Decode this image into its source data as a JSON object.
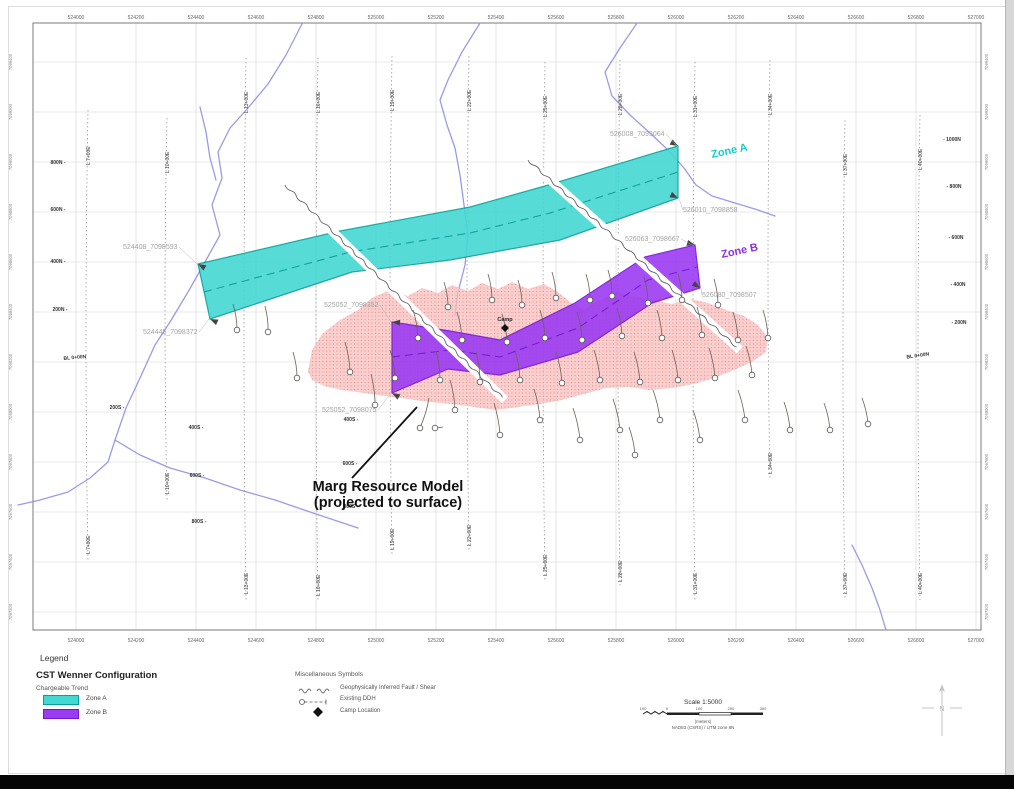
{
  "map": {
    "frame": {
      "left": 33,
      "top": 23,
      "right": 981,
      "bottom": 630
    },
    "grid": {
      "x0": 76,
      "dx": 60,
      "y0": 62,
      "dy": 50
    },
    "easting_labels": [
      "524000",
      "524200",
      "524400",
      "524600",
      "524800",
      "525000",
      "525200",
      "525400",
      "525600",
      "525800",
      "526000",
      "526200",
      "526400",
      "526600",
      "526800",
      "527000"
    ],
    "northing_labels": [
      "7099400",
      "7099200",
      "7099000",
      "7098800",
      "7098600",
      "7098400",
      "7098200",
      "7098000",
      "7097800",
      "7097600",
      "7097400",
      "7097200"
    ],
    "colors": {
      "grid": "#d2d2d2",
      "frame": "#7a7a7a",
      "stream": "#8f8fe8",
      "survey": "#9a9a9a",
      "zone_a_fill": "#44D8D2",
      "zone_a_border": "#0A9E98",
      "zone_a_text": "#17CCC6",
      "zone_b_fill": "#9B3BF2",
      "zone_b_border": "#7716D8",
      "zone_b_text": "#8B2BE8",
      "blob_fill": "#F7C2C0",
      "blob_dots": "#E4908C",
      "fault": "#555555",
      "drill": "#555555",
      "label_gray": "#A3A3A3",
      "axis_text": "#666666"
    },
    "survey_lines": [
      {
        "x": 88,
        "y1": 110,
        "y2": 560,
        "label": "L 7+00E"
      },
      {
        "x": 167,
        "y1": 118,
        "y2": 500,
        "label": "L 10+00E"
      },
      {
        "x": 246,
        "y1": 58,
        "y2": 600,
        "label": "L 13+00E"
      },
      {
        "x": 318,
        "y1": 58,
        "y2": 602,
        "label": "L 16+00E"
      },
      {
        "x": 392,
        "y1": 56,
        "y2": 556,
        "label": "L 19+00E"
      },
      {
        "x": 469,
        "y1": 56,
        "y2": 552,
        "label": "L 22+00E"
      },
      {
        "x": 545,
        "y1": 62,
        "y2": 582,
        "label": "L 25+00E"
      },
      {
        "x": 620,
        "y1": 60,
        "y2": 588,
        "label": "L 28+00E"
      },
      {
        "x": 695,
        "y1": 62,
        "y2": 600,
        "label": "L 31+00E"
      },
      {
        "x": 770,
        "y1": 60,
        "y2": 480,
        "label": "L 34+00E"
      },
      {
        "x": 845,
        "y1": 120,
        "y2": 600,
        "label": "L 37+00E"
      },
      {
        "x": 920,
        "y1": 115,
        "y2": 600,
        "label": "L 40+00E"
      }
    ],
    "local_labels": [
      {
        "t": "800N -",
        "x": 58,
        "y": 164
      },
      {
        "t": "600N -",
        "x": 58,
        "y": 211
      },
      {
        "t": "400N -",
        "x": 58,
        "y": 263
      },
      {
        "t": "200N -",
        "x": 60,
        "y": 311
      },
      {
        "t": "- 1000N",
        "x": 952,
        "y": 141
      },
      {
        "t": "- 800N",
        "x": 954,
        "y": 188
      },
      {
        "t": "- 600N",
        "x": 956,
        "y": 239
      },
      {
        "t": "- 400N",
        "x": 958,
        "y": 286
      },
      {
        "t": "- 200N",
        "x": 959,
        "y": 324
      },
      {
        "t": "200S -",
        "x": 117,
        "y": 409
      },
      {
        "t": "400S -",
        "x": 196,
        "y": 429
      },
      {
        "t": "600S -",
        "x": 197,
        "y": 477
      },
      {
        "t": "800S -",
        "x": 199,
        "y": 523
      },
      {
        "t": "400S -",
        "x": 351,
        "y": 421
      },
      {
        "t": "600S -",
        "x": 350,
        "y": 465
      },
      {
        "t": "800S -",
        "x": 351,
        "y": 508
      }
    ],
    "baseline_labels": [
      {
        "t": "BL 0+00N",
        "x": 75,
        "y": 359,
        "rot": -5
      },
      {
        "t": "BL 0+00N",
        "x": 918,
        "y": 357,
        "rot": -8
      }
    ],
    "collar_labels": [
      {
        "t": "524408_7098593",
        "x": 123,
        "y": 249,
        "tip": [
          197,
          264
        ]
      },
      {
        "t": "524445_7098372",
        "x": 143,
        "y": 334,
        "tip": [
          209,
          319
        ]
      },
      {
        "t": "525052_7098352",
        "x": 324,
        "y": 307,
        "tip": [
          391,
          322
        ]
      },
      {
        "t": "525052_7098075",
        "x": 322,
        "y": 412,
        "tip": [
          391,
          393
        ]
      },
      {
        "t": "526008_7099064",
        "x": 610,
        "y": 136,
        "tip": [
          678,
          147
        ]
      },
      {
        "t": "526010_7098858",
        "x": 683,
        "y": 212,
        "tip": [
          679,
          199
        ]
      },
      {
        "t": "526063_7098667",
        "x": 625,
        "y": 241,
        "tip": [
          694,
          246
        ]
      },
      {
        "t": "526080_7098507",
        "x": 702,
        "y": 297,
        "tip": [
          701,
          289
        ]
      }
    ],
    "zone_a": {
      "label": "Zone A",
      "label_x": 712,
      "label_y": 158,
      "label_rot": -12,
      "polygon": [
        [
          198,
          264
        ],
        [
          340,
          231
        ],
        [
          470,
          207
        ],
        [
          545,
          186
        ],
        [
          678,
          146
        ],
        [
          678,
          198
        ],
        [
          560,
          240
        ],
        [
          450,
          260
        ],
        [
          352,
          272
        ],
        [
          210,
          319
        ]
      ],
      "centerline": [
        [
          204,
          292
        ],
        [
          350,
          252
        ],
        [
          470,
          233
        ],
        [
          550,
          213
        ],
        [
          678,
          172
        ]
      ],
      "tips": [
        [
          198,
          264,
          210
        ],
        [
          210,
          319,
          205
        ],
        [
          678,
          146,
          30
        ],
        [
          678,
          198,
          25
        ]
      ]
    },
    "zone_b": {
      "label": "Zone B",
      "label_x": 722,
      "label_y": 258,
      "label_rot": -12,
      "polygon": [
        [
          392,
          322
        ],
        [
          450,
          331
        ],
        [
          500,
          340
        ],
        [
          575,
          303
        ],
        [
          645,
          257
        ],
        [
          695,
          245
        ],
        [
          700,
          288
        ],
        [
          652,
          303
        ],
        [
          578,
          352
        ],
        [
          500,
          375
        ],
        [
          448,
          369
        ],
        [
          392,
          393
        ]
      ],
      "centerline": [
        [
          392,
          357
        ],
        [
          450,
          350
        ],
        [
          500,
          357
        ],
        [
          578,
          328
        ],
        [
          648,
          280
        ],
        [
          697,
          267
        ]
      ],
      "tips": [
        [
          392,
          322,
          185
        ],
        [
          392,
          393,
          210
        ],
        [
          695,
          245,
          15
        ],
        [
          700,
          288,
          35
        ]
      ]
    },
    "faults": [
      {
        "from": [
          285,
          185
        ],
        "to": [
          505,
          400
        ]
      },
      {
        "from": [
          528,
          160
        ],
        "to": [
          740,
          350
        ]
      }
    ],
    "streams": [
      [
        [
          302,
          24
        ],
        [
          286,
          55
        ],
        [
          268,
          84
        ],
        [
          248,
          108
        ],
        [
          230,
          128
        ],
        [
          218,
          152
        ],
        [
          222,
          178
        ],
        [
          212,
          205
        ],
        [
          220,
          235
        ],
        [
          205,
          262
        ],
        [
          188,
          292
        ],
        [
          170,
          322
        ],
        [
          155,
          345
        ],
        [
          140,
          378
        ],
        [
          126,
          408
        ],
        [
          115,
          440
        ],
        [
          108,
          462
        ],
        [
          90,
          478
        ],
        [
          68,
          492
        ],
        [
          40,
          500
        ],
        [
          18,
          505
        ]
      ],
      [
        [
          200,
          107
        ],
        [
          206,
          132
        ],
        [
          210,
          158
        ],
        [
          216,
          180
        ]
      ],
      [
        [
          115,
          440
        ],
        [
          140,
          455
        ],
        [
          170,
          468
        ],
        [
          205,
          478
        ],
        [
          240,
          490
        ],
        [
          275,
          500
        ],
        [
          310,
          512
        ],
        [
          340,
          522
        ],
        [
          358,
          528
        ]
      ],
      [
        [
          480,
          23
        ],
        [
          462,
          52
        ],
        [
          448,
          80
        ],
        [
          440,
          100
        ],
        [
          447,
          125
        ],
        [
          455,
          148
        ],
        [
          460,
          175
        ],
        [
          464,
          205
        ],
        [
          468,
          235
        ],
        [
          465,
          265
        ],
        [
          458,
          292
        ],
        [
          455,
          315
        ]
      ],
      [
        [
          637,
          23
        ],
        [
          620,
          48
        ],
        [
          605,
          72
        ],
        [
          612,
          96
        ],
        [
          630,
          115
        ],
        [
          650,
          133
        ],
        [
          668,
          150
        ],
        [
          684,
          168
        ],
        [
          696,
          185
        ],
        [
          712,
          196
        ],
        [
          735,
          203
        ],
        [
          758,
          210
        ],
        [
          775,
          216
        ]
      ],
      [
        [
          852,
          545
        ],
        [
          862,
          565
        ],
        [
          872,
          588
        ],
        [
          880,
          610
        ],
        [
          886,
          630
        ]
      ]
    ],
    "resource_model": {
      "annotation_lines": [
        "Marg Resource Model",
        "(projected to surface)"
      ],
      "annotation_x": 388,
      "annotation_y": 491,
      "leader": [
        [
          417,
          407
        ],
        [
          352,
          478
        ]
      ],
      "outline": [
        [
          308,
          372
        ],
        [
          312,
          350
        ],
        [
          322,
          334
        ],
        [
          340,
          320
        ],
        [
          358,
          310
        ],
        [
          372,
          298
        ],
        [
          390,
          290
        ],
        [
          408,
          296
        ],
        [
          422,
          288
        ],
        [
          438,
          293
        ],
        [
          452,
          285
        ],
        [
          468,
          291
        ],
        [
          482,
          283
        ],
        [
          498,
          289
        ],
        [
          512,
          282
        ],
        [
          528,
          289
        ],
        [
          544,
          284
        ],
        [
          558,
          292
        ],
        [
          570,
          302
        ],
        [
          584,
          310
        ],
        [
          600,
          300
        ],
        [
          618,
          292
        ],
        [
          636,
          297
        ],
        [
          654,
          300
        ],
        [
          672,
          304
        ],
        [
          690,
          299
        ],
        [
          708,
          303
        ],
        [
          726,
          310
        ],
        [
          744,
          316
        ],
        [
          758,
          325
        ],
        [
          768,
          338
        ],
        [
          766,
          352
        ],
        [
          752,
          362
        ],
        [
          734,
          370
        ],
        [
          714,
          378
        ],
        [
          694,
          384
        ],
        [
          672,
          388
        ],
        [
          650,
          390
        ],
        [
          628,
          387
        ],
        [
          606,
          388
        ],
        [
          584,
          394
        ],
        [
          562,
          400
        ],
        [
          540,
          404
        ],
        [
          518,
          407
        ],
        [
          496,
          410
        ],
        [
          474,
          407
        ],
        [
          452,
          404
        ],
        [
          430,
          402
        ],
        [
          408,
          399
        ],
        [
          386,
          396
        ],
        [
          364,
          393
        ],
        [
          342,
          390
        ],
        [
          324,
          386
        ],
        [
          312,
          380
        ]
      ]
    },
    "camp": {
      "label": "Camp",
      "x": 505,
      "y": 328
    },
    "drillholes": [
      [
        237,
        330,
        233,
        304
      ],
      [
        268,
        332,
        265,
        306
      ],
      [
        297,
        378,
        293,
        352
      ],
      [
        350,
        372,
        345,
        342
      ],
      [
        375,
        405,
        371,
        374
      ],
      [
        395,
        378,
        390,
        350
      ],
      [
        418,
        338,
        413,
        310
      ],
      [
        420,
        428,
        429,
        398
      ],
      [
        440,
        380,
        436,
        351
      ],
      [
        448,
        307,
        444,
        282
      ],
      [
        455,
        410,
        450,
        380
      ],
      [
        462,
        340,
        457,
        312
      ],
      [
        480,
        382,
        476,
        352
      ],
      [
        492,
        300,
        488,
        274
      ],
      [
        500,
        435,
        494,
        403
      ],
      [
        507,
        342,
        502,
        314
      ],
      [
        520,
        380,
        515,
        350
      ],
      [
        522,
        305,
        518,
        280
      ],
      [
        540,
        420,
        534,
        389
      ],
      [
        545,
        338,
        540,
        310
      ],
      [
        556,
        298,
        552,
        272
      ],
      [
        562,
        383,
        556,
        352
      ],
      [
        580,
        440,
        573,
        408
      ],
      [
        582,
        340,
        577,
        312
      ],
      [
        590,
        300,
        586,
        274
      ],
      [
        600,
        380,
        594,
        350
      ],
      [
        612,
        296,
        608,
        270
      ],
      [
        620,
        430,
        613,
        399
      ],
      [
        622,
        336,
        617,
        308
      ],
      [
        640,
        382,
        634,
        352
      ],
      [
        648,
        303,
        644,
        277
      ],
      [
        660,
        420,
        653,
        390
      ],
      [
        662,
        338,
        657,
        310
      ],
      [
        678,
        380,
        672,
        350
      ],
      [
        682,
        300,
        678,
        274
      ],
      [
        700,
        440,
        693,
        410
      ],
      [
        702,
        335,
        697,
        307
      ],
      [
        715,
        378,
        709,
        348
      ],
      [
        718,
        305,
        714,
        279
      ],
      [
        738,
        340,
        733,
        312
      ],
      [
        745,
        420,
        738,
        390
      ],
      [
        752,
        375,
        746,
        346
      ],
      [
        768,
        338,
        763,
        310
      ],
      [
        790,
        430,
        784,
        402
      ],
      [
        830,
        430,
        824,
        403
      ],
      [
        868,
        424,
        862,
        398
      ],
      [
        635,
        455,
        629,
        427
      ],
      [
        435,
        428,
        443,
        427
      ]
    ]
  },
  "legend": {
    "title": "Legend",
    "cst": {
      "heading": "CST Wenner Configuration",
      "subheading": "Chargeable Trend",
      "items": [
        {
          "label": "Zone A",
          "color": "#44D8D2",
          "border": "#0A9E98"
        },
        {
          "label": "Zone B",
          "color": "#9B3BF2",
          "border": "#7716D8"
        }
      ]
    },
    "misc": {
      "heading": "Miscellaneous Symbols",
      "items": [
        {
          "symbol": "fault-squiggle",
          "label": "Geophysically Inferred Fault / Shear"
        },
        {
          "symbol": "existing-ddh",
          "label": "Existing DDH"
        },
        {
          "symbol": "camp-diamond",
          "label": "Camp Location"
        }
      ]
    },
    "scale": {
      "title": "Scale 1:5000",
      "ticks": [
        "100",
        "0",
        "100",
        "200",
        "300"
      ],
      "units": "(meters)",
      "datum": "NAD83 (CSRS) / UTM zone 8N"
    }
  }
}
